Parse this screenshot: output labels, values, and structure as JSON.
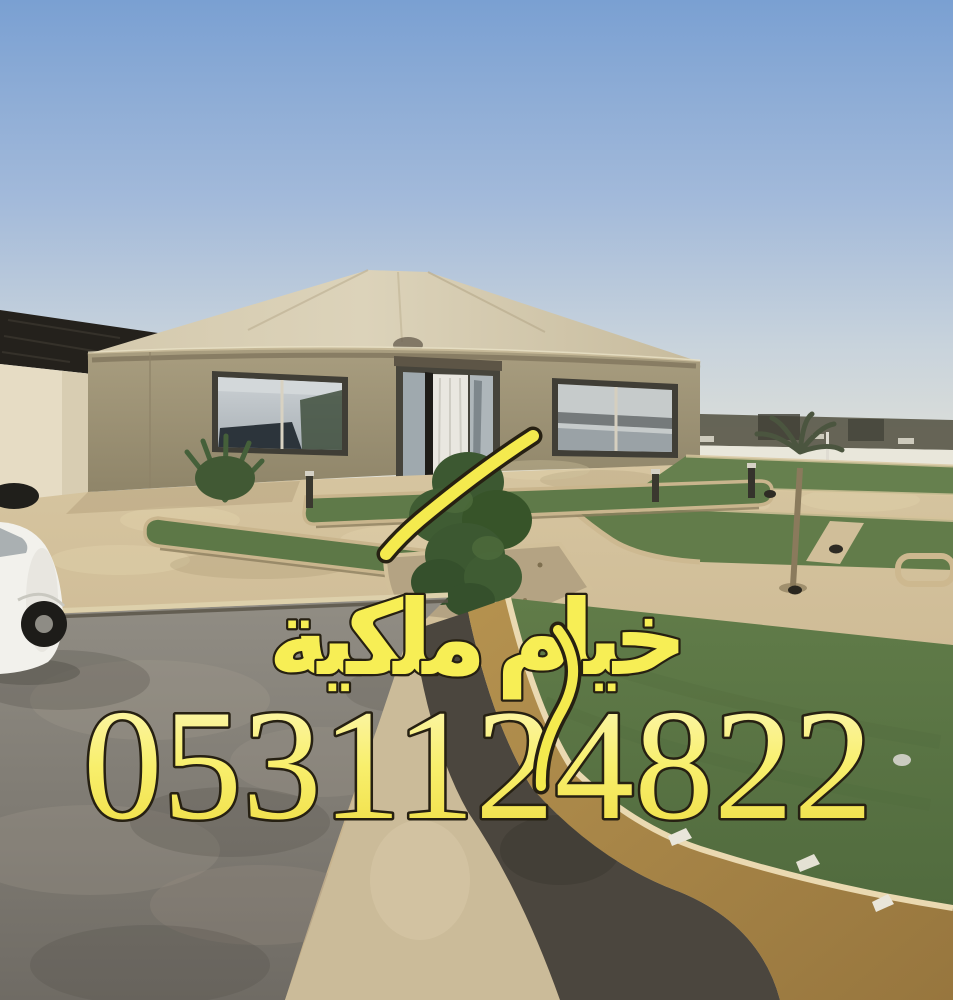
{
  "overlay": {
    "brand_text": "خيام ملكية",
    "phone_number": "0531124822"
  },
  "palette": {
    "text_fill_yellow": "#f7ee55",
    "text_outline_dark": "#262012",
    "sky_top_blue": "#7aa0d2",
    "sky_horizon_haze": "#e3e2d8",
    "tent_roof_beige": "#d4c9ad",
    "tent_wall_khaki": "#a1967a",
    "grass_green": "#5f7a49",
    "curb_tan": "#b5924f",
    "pavement_sand": "#d0bd98",
    "asphalt_gray": "#7d796f",
    "left_roof_dark": "#24211c",
    "car_white": "#f2f1ec"
  }
}
